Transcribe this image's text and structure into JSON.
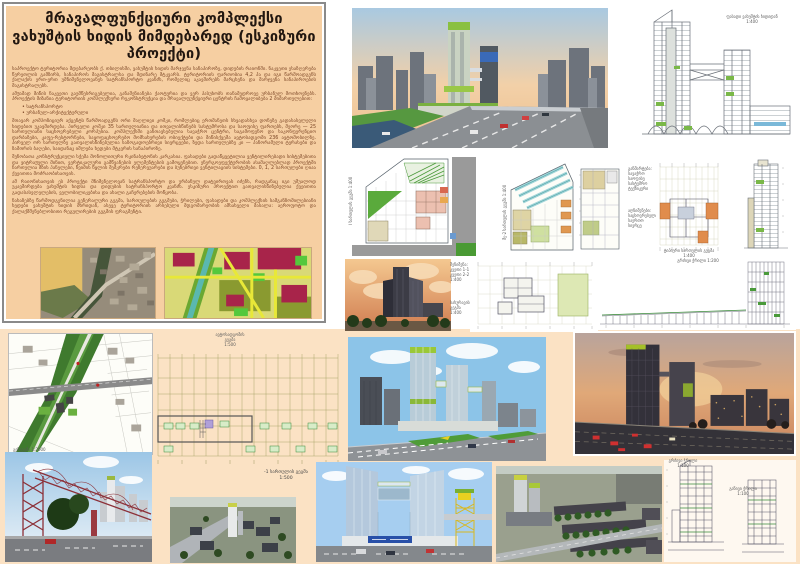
{
  "title": "მრავალფუნქციური კომპლექსი ვახუშტის ხიდის მიმდებარედ (ესკიზური პროექტი)",
  "text_panel": {
    "paragraphs": [
      "საპროექტო ტერიტორია მდებარეობს ქ. თბილისში, ვახუშტის ხიდის მარჯვენა სანაპიროზე, დიდუბის რაიონში. ნაკვეთი ესაზღვრება წერეთლის გამზირს, სანაპიროს მაგისტრალსა და მდინარე მტკვარს. ტერიტორიის ფართობია 4,2 ჰა და იგი წარმოადგენს ქალაქის ერთ-ერთ უმნიშვნელოვანეს სატრანსპორტო კვანძს, რომელიც აკავშირებს მარცხენა და მარჯვენა სანაპიროების მაგისტრალებს.",
      "ამჟამად მიწის ნაკვეთი გაუმწესრიგებელია, განაშენიანება ქაოტურია და ვერ პასუხობს თანამედროვე ურბანულ მოთხოვნებს. პროექტის მიზანია ტერიტორიის კომპლექსური რეკონსტრუქცია და მრავალფუნქციური ცენტრის ჩამოყალიბება 2 მიმართულებით:",
      "მთავარ კომპოზიციურ აქცენტს წარმოადგენს ორი მაღლივი კოშკი, რომლებიც ერთმანეთს სხვადასხვა დონეზე გადასასვლელი ხიდებით უკავშირდება. პირველი კოშკი 35 სართულიანია და ითვალისწინებს სასტუმროსა და საოფისე ფართებს, მეორე — 25 სართულიანი საცხოვრებელი კორპუსია. კომპლექსში განთავსებულია სავაჭრო ცენტრი, საგამოფენო და საკონფერენციო დარბაზები, კაფე-რესტორნები, საყოფაცხოვრებო მომსახურების ობიექტები და მიწისქვეშა ავტოსადგომი 236 ავტომობილზე. პირველ ორ სართულზე გათვალისწინებულია საზოგადოებრივი სივრცეები, ზედა სართულებზე კი — პანორამული ტერასები და ზამთრის ბაღები, საიდანაც იშლება ხედები მტკვრის სანაპიროზე.",
      "შენობათა კონსტრუქციული სქემა მონოლითური რკინაბეტონის კარკასია. ფასადები გადაწყვეტილია ვენტილირებადი სისტემებითა და ვიტრაჟული მინით, ვერტიკალური გამწვანების ელემენტების გამოყენებით. ენერგოეფექტურობის ასამაღლებლად პროექტში ჩართულია მზის პანელები, წვიმის წყლის შემკრები რეზერვუარები და ბუნებრივი ვენტილაციის სისტემები. 0, 1, 2 სართულები ღიაა ქვეითთა მოძრაობისათვის.",
      "ამ რაიონისათვის ეს პროექტი მნიშვნელოვან სატრანსპორტო და ურბანულ დატვირთვას იძენს, რადგანაც იგი უშუალოდ უკავშირდება ვახუშტის ხიდსა და დიდუბის სატრანსპორტო კვანძს. ესკიზური პროექტით გათვალისწინებულია ქვეითთა გადასასვლელების, ველობილიკებისა და ახალი გაჩერებების მოწყობა.",
      "ნახაზებზე წარმოდგენილია გენერალური გეგმა, სართულების გეგმები, ჭრილები, ფასადები და კომპლექსის სამგანზომილებიანი ხედები ვახუშტის ხიდის მხრიდან, ასევე ტერიტორიის არსებული მდგომარეობის ამსახველი მასალა: აეროფოტო და ქალაქმშენებლობითი რეგულირების გეგმის ფრაგმენტი."
    ],
    "bullets": [
      "სატრანსპორტო",
      "ურბანულ-არქიტექტურული"
    ]
  },
  "captions": {
    "facade": "ფასადი ვახუშტის ხიდიდან\n1:400",
    "plan_a_label": "I სართულის გეგმა 1:400",
    "plan_b_label": "მე-2 სართულის გეგმა 1:400",
    "legend_1": "განმარტება:\nსავაჭრო\nსაოფისე\nსასტუმრო\nტექნიკური",
    "legend_2": "აღნიშვნები:\nსაცხოვრებელი\nსაერთო სივრცე",
    "plan_typical": "ტიპიური სართულის გეგმა\n1:400",
    "notes_1": "შენიშვნა:\nკვეთი 1-1\nკვეთი 2-2\n1:400",
    "notes_2": "სახურავის\nგეგმა\n1:400",
    "section_long": "გრძივი ჭრილი 1:200",
    "parking_caption": "ავტოსადგომის\nგეგმა\n1:500",
    "basement_caption": "-1 სართულის გეგმა\n1:500",
    "siteplan_label": "გენგეგმა 1:2000",
    "section_a": "გრძივი ჭრილი\n1:100",
    "section_b": "განივი ჭრილი\n1:100"
  },
  "colors": {
    "panel_bg": "#f6cfa2",
    "bottom_bg": "#fbe2c4",
    "body_text": "#7a4424",
    "accent_green": "#7ab648",
    "drawing_line": "#5a6472",
    "zoning_crimson": "#a8244a",
    "zoning_yellow": "#d9d977",
    "sunset_orange": "#e0a878",
    "day_sky_blue": "#8cc4e8",
    "truss_red": "#8c3038"
  }
}
